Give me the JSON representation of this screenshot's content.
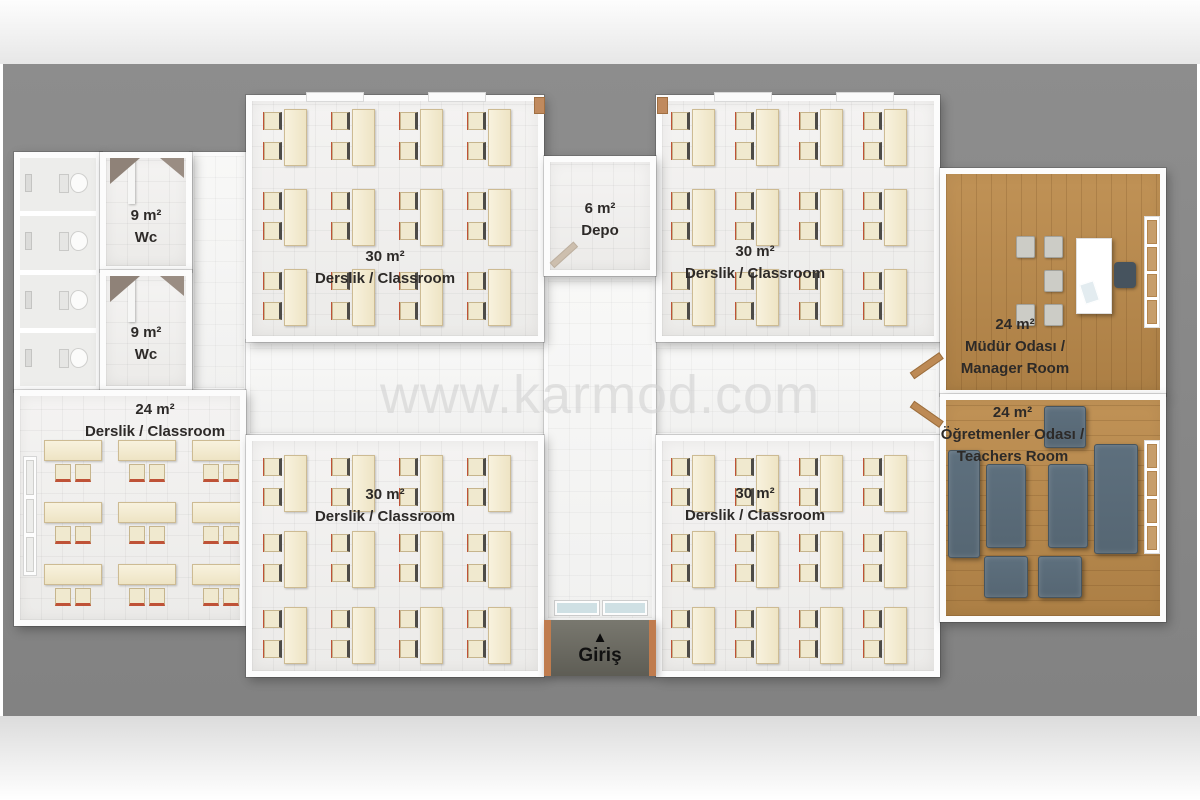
{
  "watermark": "www.karmod.com",
  "rooms": {
    "wc_top": {
      "area": "9 m²",
      "name": "Wc"
    },
    "wc_bottom": {
      "area": "9 m²",
      "name": "Wc"
    },
    "depo": {
      "area": "6 m²",
      "name": "Depo"
    },
    "classroom_left": {
      "area": "24 m²",
      "name": "Derslik  / Classroom"
    },
    "classroom_top_left": {
      "area": "30 m²",
      "name": "Derslik  / Classroom"
    },
    "classroom_top_right": {
      "area": "30 m²",
      "name": "Derslik  / Classroom"
    },
    "classroom_bottom_left": {
      "area": "30 m²",
      "name": "Derslik  / Classroom"
    },
    "classroom_bottom_right": {
      "area": "30 m²",
      "name": "Derslik  / Classroom"
    },
    "manager": {
      "area": "24 m²",
      "name_tr": "Müdür Odası /",
      "name_en": "Manager Room"
    },
    "teachers": {
      "area": "24 m²",
      "name_tr": "Öğretmenler Odası /",
      "name_en": "Teachers Room"
    }
  },
  "entrance": {
    "label": "Giriş",
    "arrow": "▲"
  },
  "colors": {
    "backdrop_gray": "#8a8a8a",
    "wall_white": "#fcfcfc",
    "floor_tile": "#f2f1ef",
    "desk_cream": "#f5efd9",
    "desk_accent_red": "#bf5237",
    "wood_floor": "#b5854b",
    "sofa_gray_blue": "#5d6f7d",
    "entrance_mat": "#6b6b64",
    "door_wood": "#bd8a55",
    "label_text": "#2d2a28",
    "watermark_gray": "#d2d2d2"
  }
}
